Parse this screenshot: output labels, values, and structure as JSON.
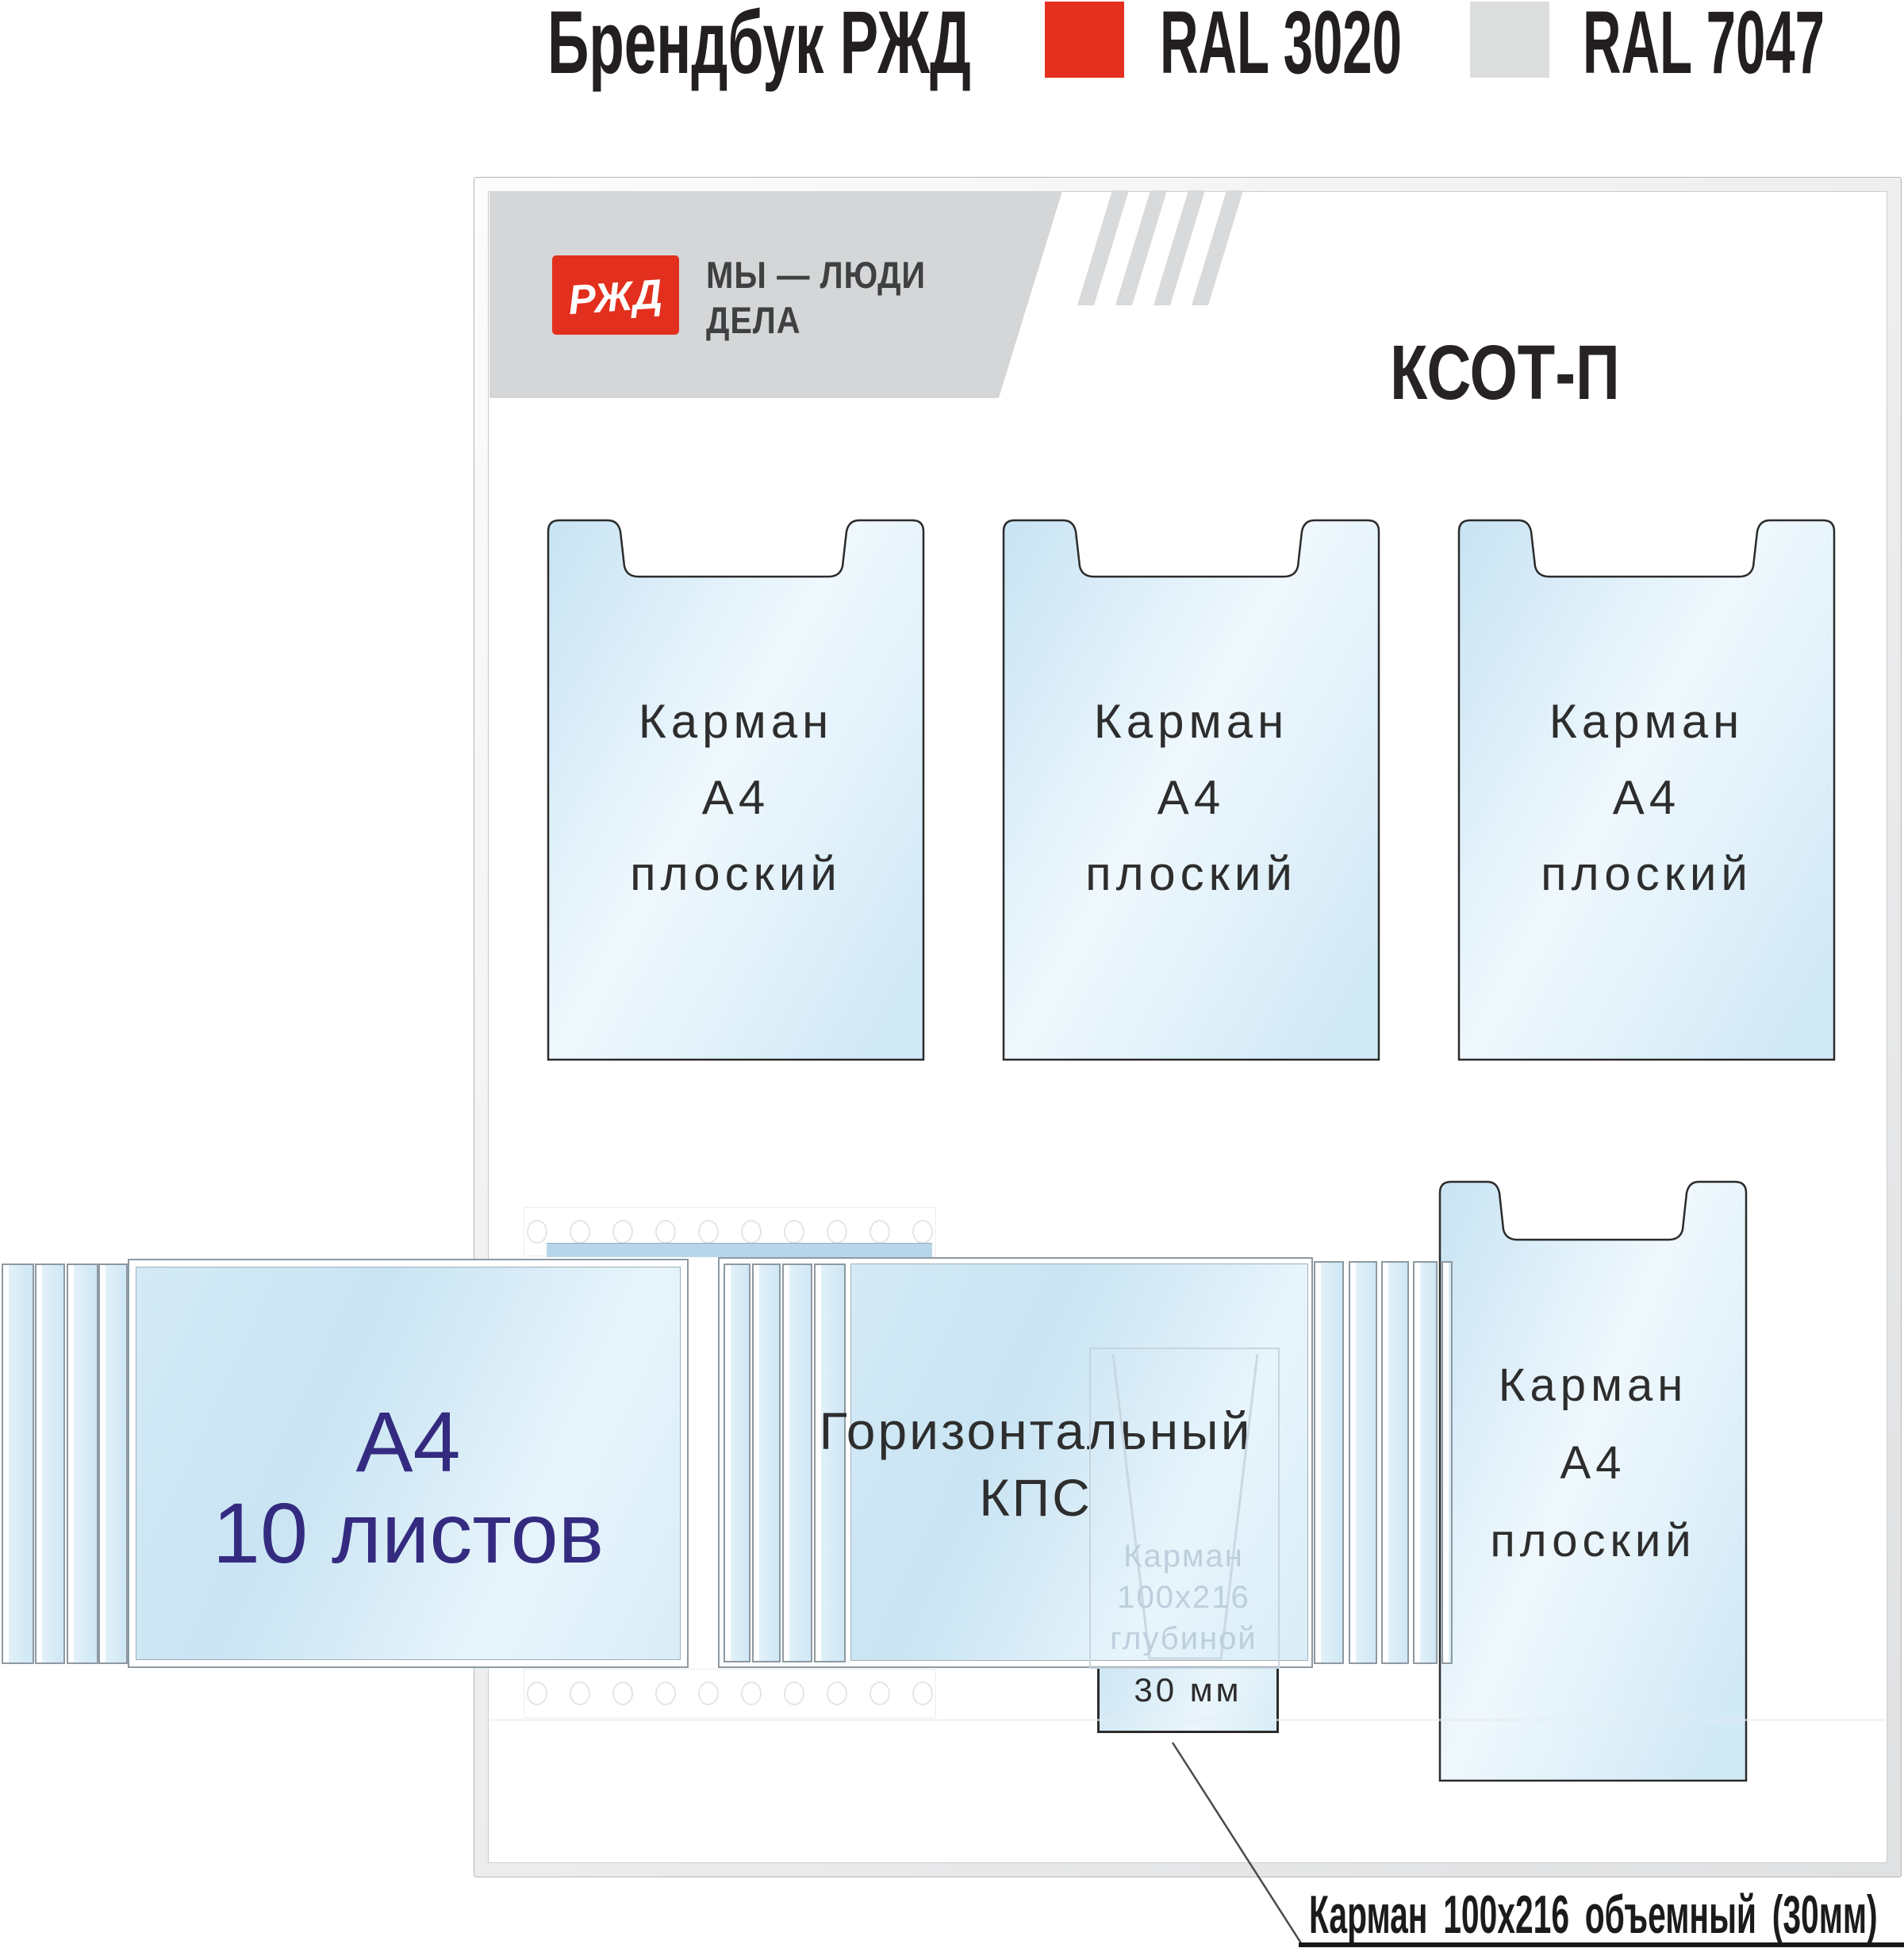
{
  "header": {
    "title": "Брендбук РЖД",
    "swatches": [
      {
        "name": "RAL 3020",
        "color": "#e5301f"
      },
      {
        "name": "RAL 7047",
        "color": "#dcdddd"
      }
    ]
  },
  "board": {
    "logo": {
      "text": "РЖД"
    },
    "slogan": {
      "line1": "МЫ — ЛЮДИ",
      "line2": "ДЕЛА"
    },
    "title": "КСОТ-П",
    "flat_pockets": [
      {
        "lines": [
          "Карман",
          "А4",
          "плоский"
        ]
      },
      {
        "lines": [
          "Карман",
          "А4",
          "плоский"
        ]
      },
      {
        "lines": [
          "Карман",
          "А4",
          "плоский"
        ]
      },
      {
        "lines": [
          "Карман",
          "А4",
          "плоский"
        ]
      }
    ],
    "flip_a4": {
      "line1": "А4",
      "line2": "10 листов"
    },
    "flip_kps": {
      "line1": "Горизонтальный",
      "line2": "КПС"
    },
    "small_pocket": {
      "ghost_line1": "Карман",
      "ghost_line2": "100x216",
      "ghost_line3": "глубиной",
      "visible_line": "30 мм"
    },
    "callout": "Карман 100х216 объемный (30мм)"
  },
  "colors": {
    "ral_3020": "#e5301f",
    "ral_7047": "#dcdddd",
    "logo_red": "#e3301e",
    "flip_text_blue": "#342b80",
    "band_gray": "#d5d6d7"
  }
}
